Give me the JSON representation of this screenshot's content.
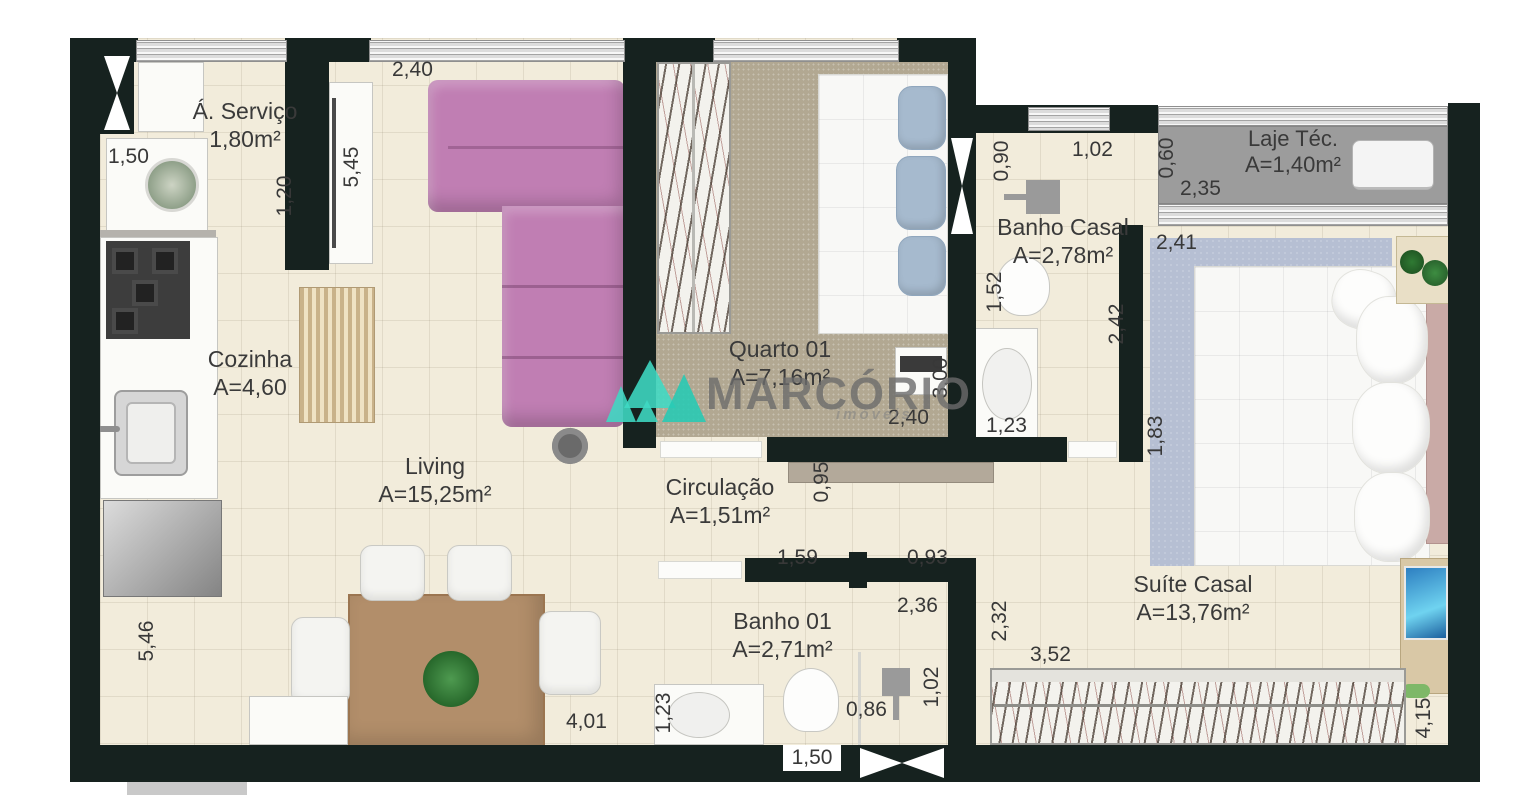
{
  "watermark": {
    "brand": "MARCÓRIO",
    "sub": "imóveis"
  },
  "rooms": {
    "servico": {
      "name": "Á. Serviço",
      "area": "1,80m²"
    },
    "cozinha": {
      "name": "Cozinha",
      "area": "A=4,60"
    },
    "living": {
      "name": "Living",
      "area": "A=15,25m²"
    },
    "quarto01": {
      "name": "Quarto 01",
      "area": "A=7,16m²"
    },
    "banho_casal": {
      "name": "Banho Casal",
      "area": "A=2,78m²"
    },
    "laje_tec": {
      "name": "Laje Téc.",
      "area": "A=1,40m²"
    },
    "suite_casal": {
      "name": "Suíte Casal",
      "area": "A=13,76m²"
    },
    "circulacao": {
      "name": "Circulação",
      "area": "A=1,51m²"
    },
    "banho01": {
      "name": "Banho 01",
      "area": "A=2,71m²"
    }
  },
  "dims": {
    "servico_width": "1,50",
    "living_left_height": "5,45",
    "tv_wall": "1,20",
    "living_window": "2,40",
    "casal_shaft": "0,90",
    "casal_window": "1,02",
    "laje_height": "0,60",
    "laje_width": "2,35",
    "suite_window": "2,41",
    "casal_toilet_depth": "1,52",
    "casal_depth": "2,42",
    "quarto_depth": "3,00",
    "quarto_width": "2,40",
    "casal_vanity_width": "1,23",
    "suite_left_wall": "1,83",
    "circulacao_width": "0,95",
    "banho01_top_left": "1,59",
    "banho01_top_right": "0,93",
    "banho01_width": "2,36",
    "suite_entry_depth": "2,32",
    "suite_closet_width": "3,52",
    "kitchen_wall_height": "5,46",
    "living_bottom_width": "4,01",
    "banho01_vanity_width": "1,23",
    "banho01_door_width": "1,50",
    "shower_width": "0,86",
    "shower_depth": "1,02",
    "suite_depth": "4,15"
  },
  "colors": {
    "wall": "#16221f",
    "floor": "#f2ecdb",
    "carpet": "#b2a892",
    "sofa": "#c07eb3",
    "rug": "#b6bfd3",
    "laje_slab": "#9c9c9c",
    "logo_teal": "#3fd9c4"
  }
}
